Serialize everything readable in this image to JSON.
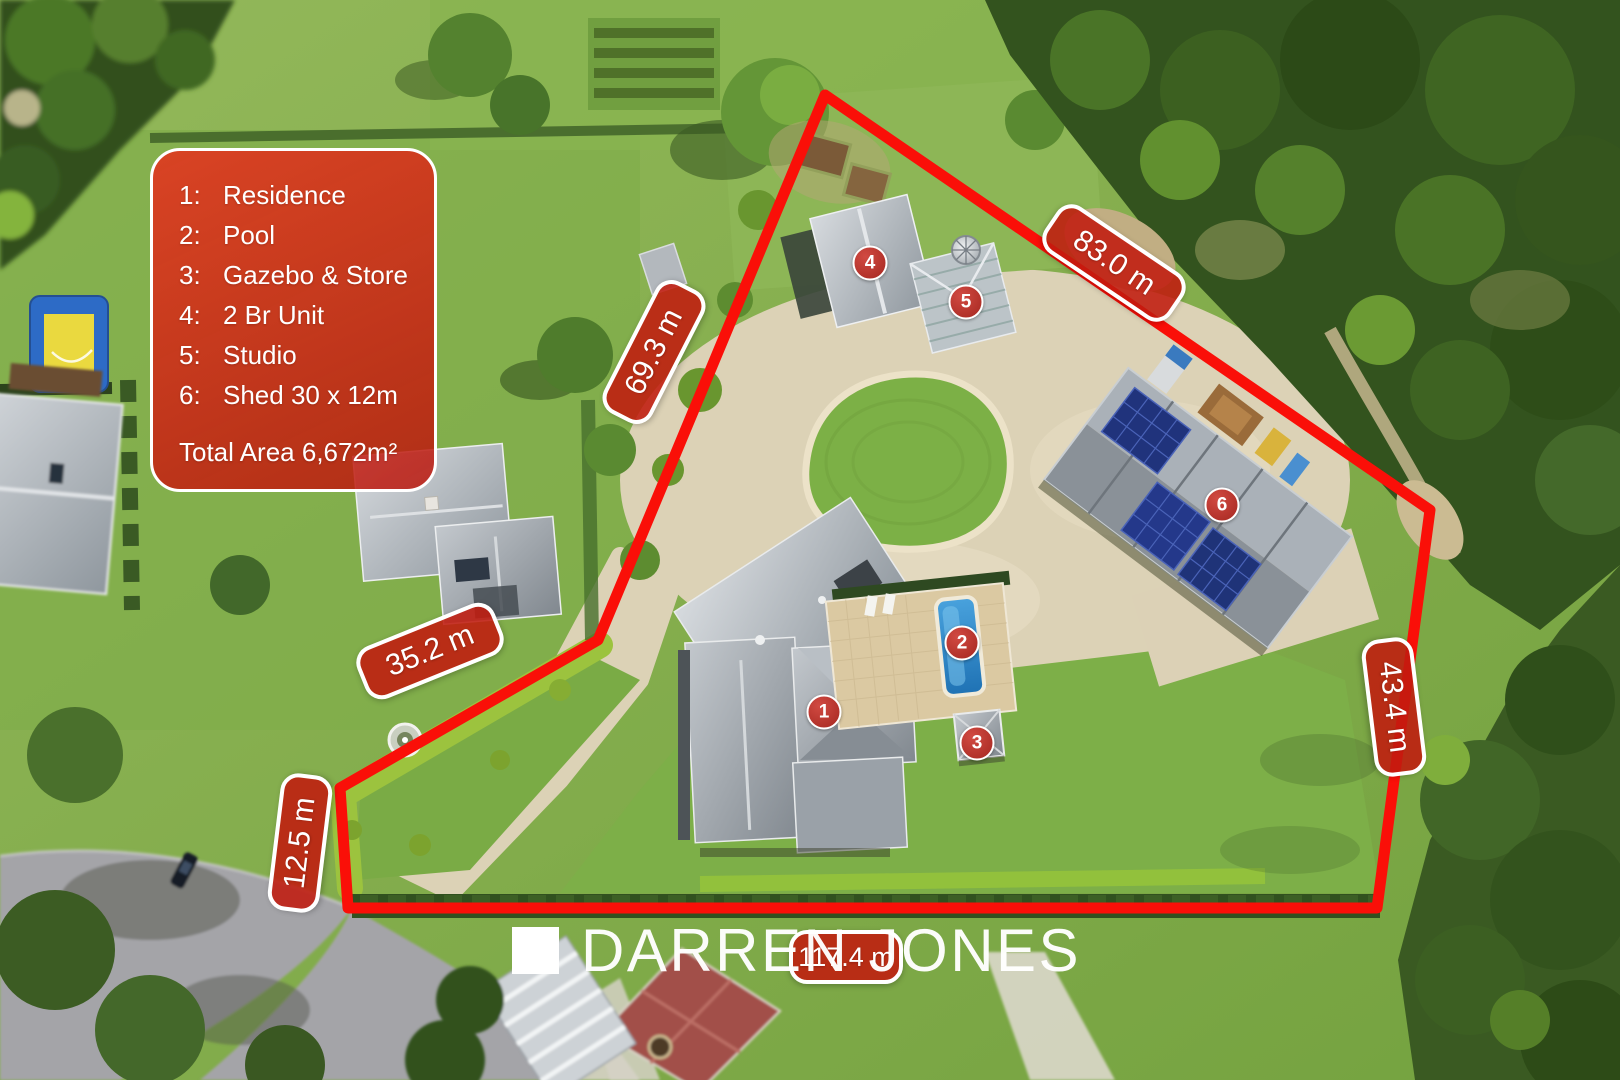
{
  "colors": {
    "boundary": "#fa0f08",
    "label_background": "#c01b0f",
    "label_border": "#ffffff",
    "marker_background": "#a52720",
    "legend_background": "#d42a18",
    "text": "#ffffff"
  },
  "legend": {
    "items": [
      {
        "num": "1:",
        "label": "Residence"
      },
      {
        "num": "2:",
        "label": "Pool"
      },
      {
        "num": "3:",
        "label": "Gazebo & Store"
      },
      {
        "num": "4:",
        "label": "2 Br Unit"
      },
      {
        "num": "5:",
        "label": "Studio"
      },
      {
        "num": "6:",
        "label": "Shed 30 x 12m"
      }
    ],
    "total_area": "Total Area 6,672m²"
  },
  "measurements": [
    {
      "text": "83.0 m"
    },
    {
      "text": "69.3 m"
    },
    {
      "text": "35.2 m"
    },
    {
      "text": "12.5 m"
    },
    {
      "text": "43.4 m"
    },
    {
      "text": "117.4 m"
    }
  ],
  "markers": [
    {
      "number": "1"
    },
    {
      "number": "2"
    },
    {
      "number": "3"
    },
    {
      "number": "4"
    },
    {
      "number": "5"
    },
    {
      "number": "6"
    }
  ],
  "watermark": {
    "brand": "DARREN JONES"
  }
}
